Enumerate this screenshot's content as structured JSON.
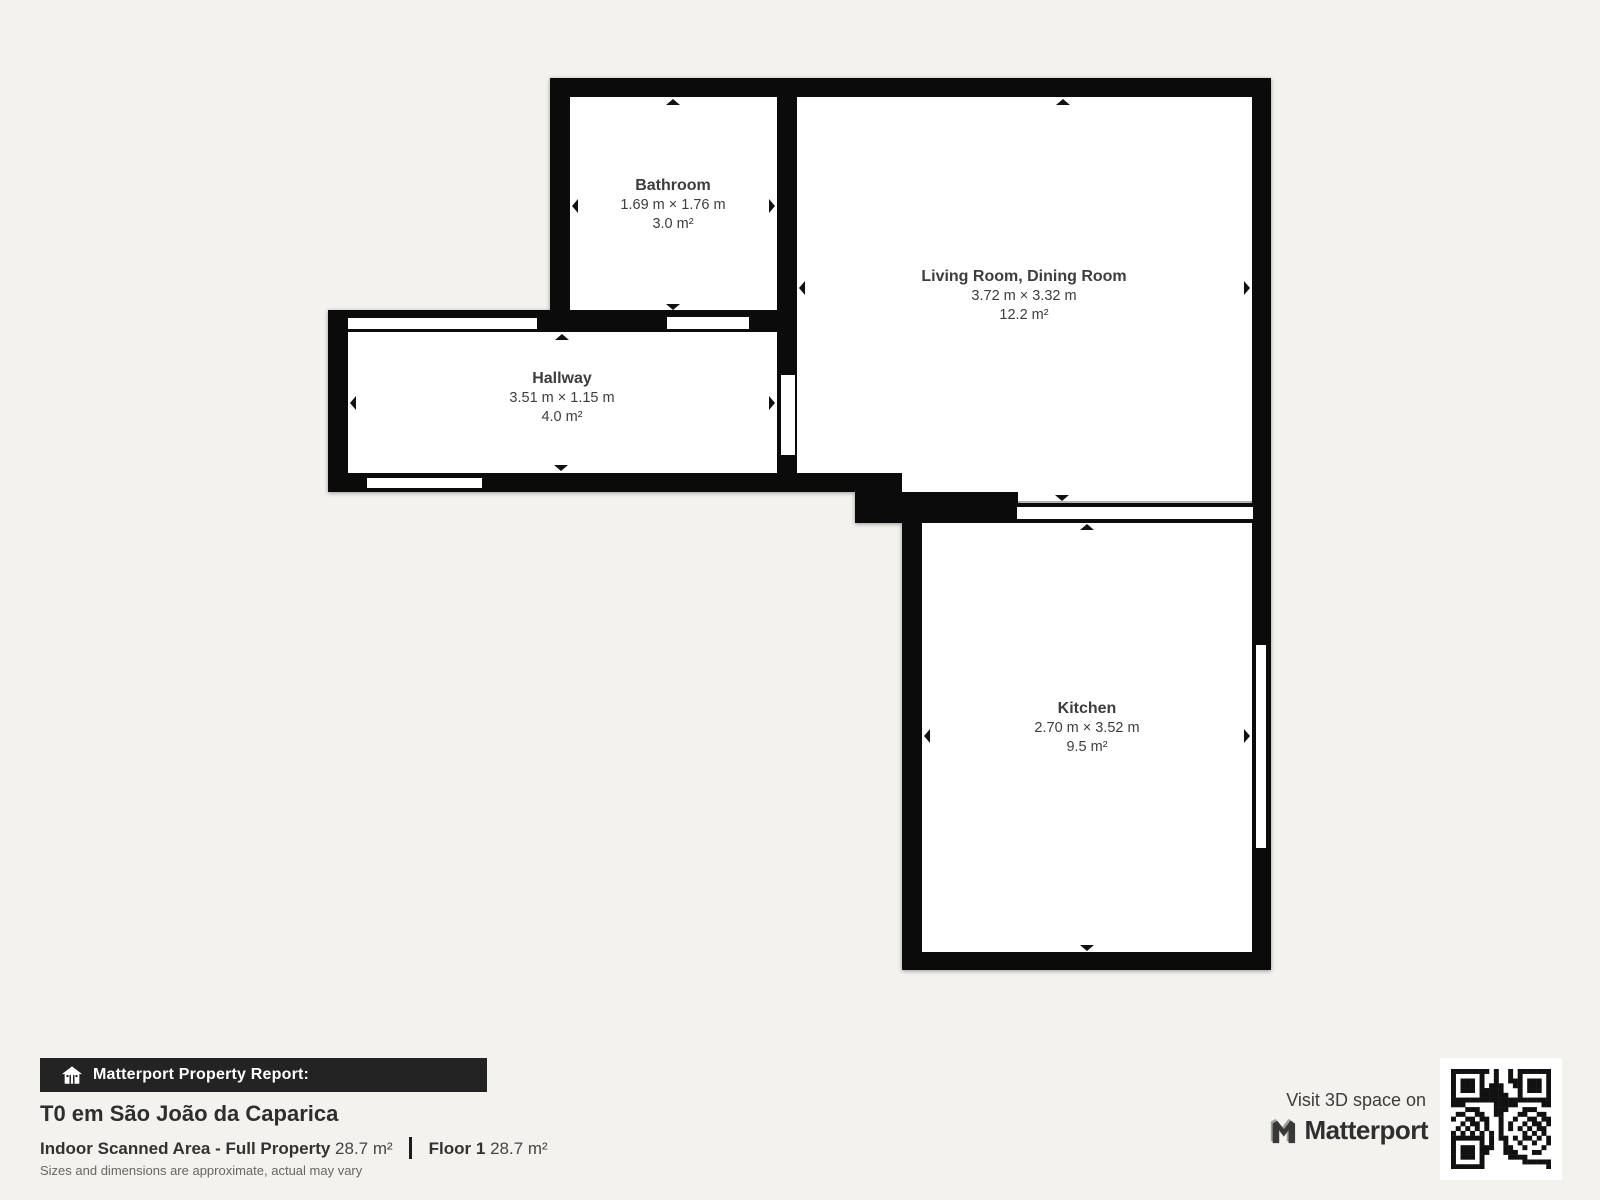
{
  "floorplan": {
    "rooms": [
      {
        "name": "Bathroom",
        "dimensions": "1.69 m × 1.76 m",
        "area": "3.0 m²"
      },
      {
        "name": "Living Room, Dining Room",
        "dimensions": "3.72 m × 3.32 m",
        "area": "12.2 m²"
      },
      {
        "name": "Hallway",
        "dimensions": "3.51 m × 1.15 m",
        "area": "4.0 m²"
      },
      {
        "name": "Kitchen",
        "dimensions": "2.70 m × 3.52 m",
        "area": "9.5 m²"
      }
    ]
  },
  "report": {
    "bar_label": "Matterport Property Report:",
    "property_title": "T0 em São João da Caparica",
    "scanned_area_label": "Indoor Scanned Area - Full Property",
    "scanned_area_value": "28.7 m²",
    "floor_label": "Floor 1",
    "floor_value": "28.7 m²",
    "disclaimer": "Sizes and dimensions are approximate, actual may vary"
  },
  "promo": {
    "visit_label": "Visit 3D space on",
    "brand_name": "Matterport"
  },
  "colors": {
    "background": "#f3f2ef",
    "wall": "#0b0b0b",
    "room_fill": "#ffffff",
    "room_text": "#3d3d3d",
    "header_bar": "#232323"
  }
}
